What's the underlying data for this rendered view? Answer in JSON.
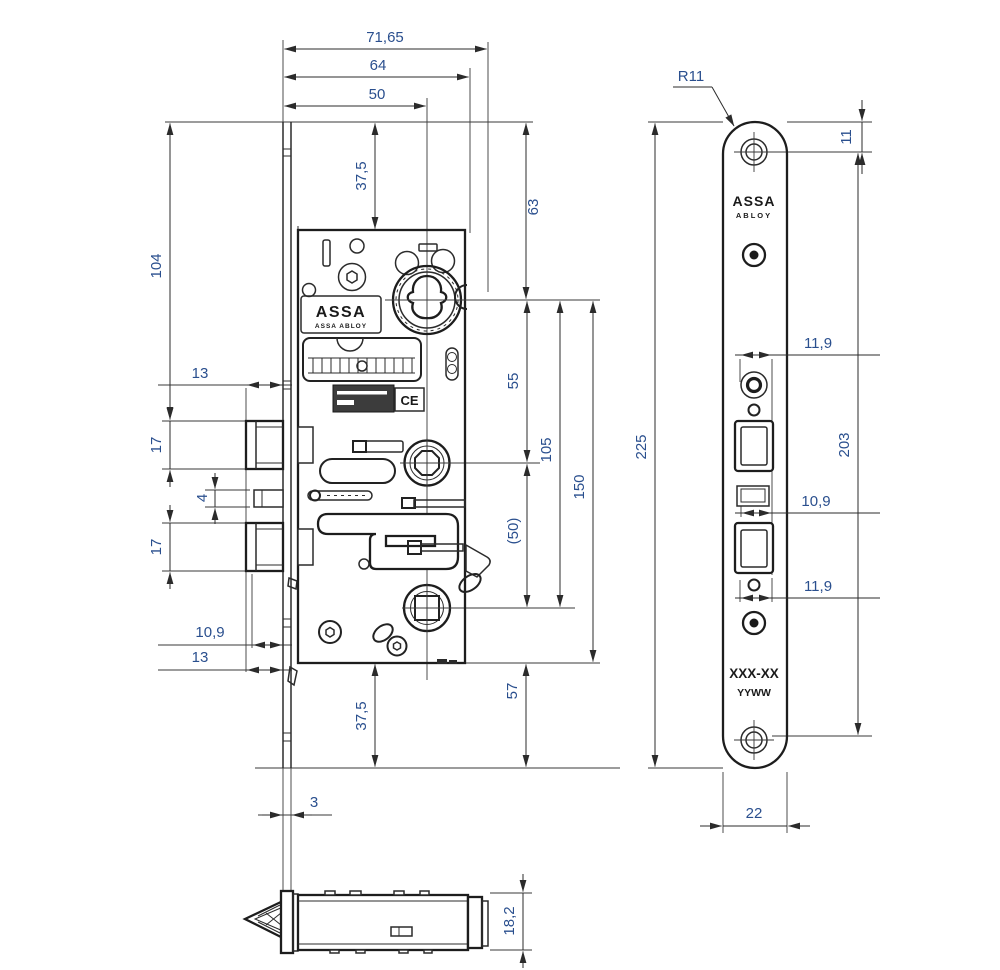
{
  "colors": {
    "line": "#2b2b2b",
    "dim_text": "#2a4f8e",
    "background": "#ffffff"
  },
  "front_view": {
    "dims": {
      "width_total": "71,65",
      "width_case": "64",
      "backset": "50",
      "top_offset": "37,5",
      "cylinder_top": "63",
      "left_height": "104",
      "latch_proj_top": "13",
      "latch_height": "17",
      "aux_height": "4",
      "bolt_height": "17",
      "bolt_proj": "10,9",
      "latch_proj_bottom": "13",
      "cyl_to_hub": "55",
      "cyl_to_bolt": "105",
      "cyl_to_case_bottom": "150",
      "hub_to_bolt_ref": "(50)",
      "bottom_offset": "37,5",
      "case_bottom": "57",
      "plate_thickness": "3"
    },
    "logo_line1": "ASSA",
    "logo_line2": "ASSA ABLOY",
    "ce_mark": "CE"
  },
  "faceplate_view": {
    "dims": {
      "corner_radius": "R11",
      "screw_top": "11",
      "plate_height": "225",
      "screw_span": "203",
      "latch_offset_top": "11,9",
      "aux_offset": "10,9",
      "bolt_offset": "11,9",
      "plate_width": "22"
    },
    "logo_line1": "ASSA",
    "logo_line2": "ABLOY",
    "marking_line1": "XXX-XX",
    "marking_line2": "YYWW"
  },
  "bottom_view": {
    "dims": {
      "case_thickness": "18,2"
    }
  }
}
